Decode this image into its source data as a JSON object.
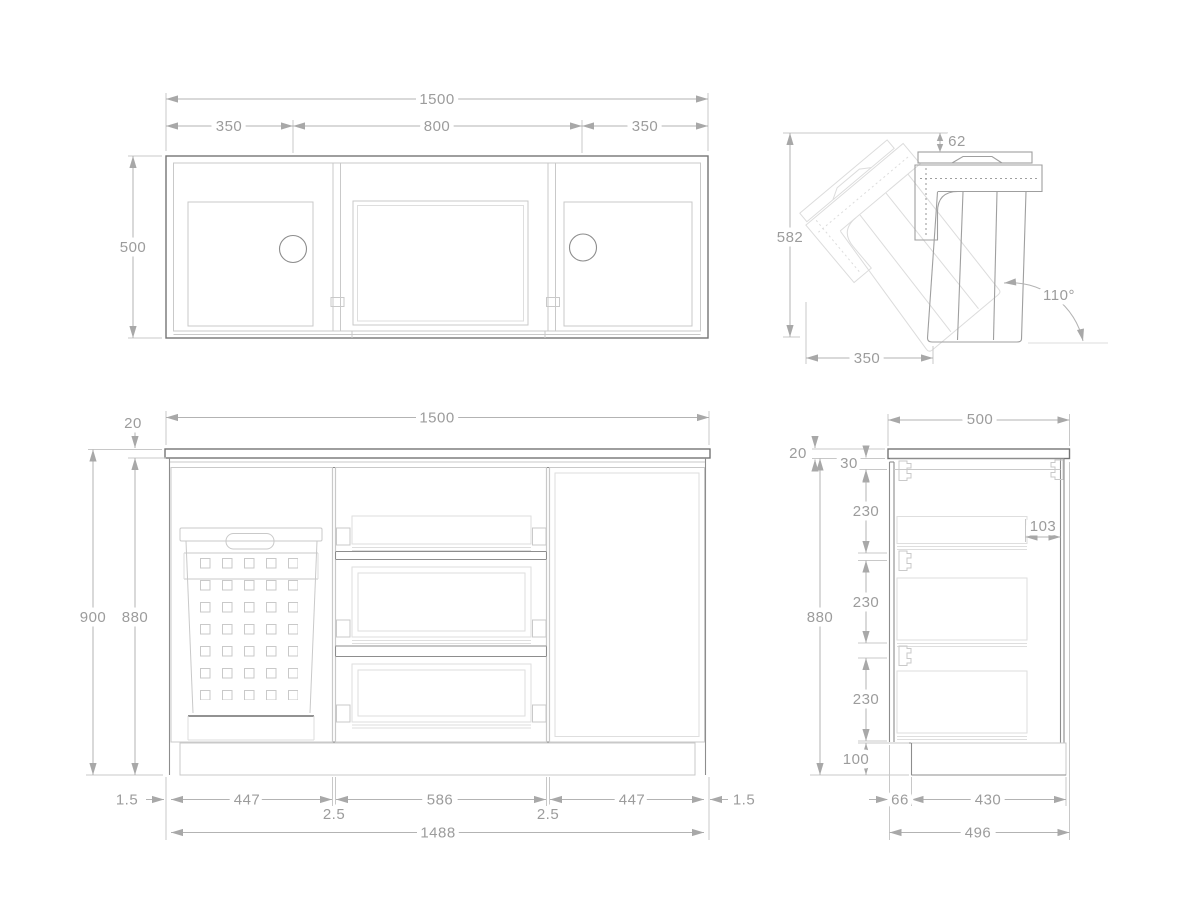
{
  "drawing": {
    "views": {
      "plan": {
        "dims": {
          "total_width": "1500",
          "bay_left": "350",
          "bay_center": "800",
          "bay_right": "350",
          "depth": "500"
        }
      },
      "tilt": {
        "dims": {
          "lid_gap": "62",
          "open_height": "582",
          "depth": "350",
          "open_angle": "110°"
        }
      },
      "front": {
        "dims": {
          "top_thickness": "20",
          "total_width": "1500",
          "total_height": "900",
          "body_height": "880",
          "gap_outer_left": "1.5",
          "front_left": "447",
          "gap_inner_left": "2.5",
          "front_center": "586",
          "gap_inner_right": "2.5",
          "front_right": "447",
          "gap_outer_right": "1.5",
          "fronts_width": "1488"
        }
      },
      "side": {
        "dims": {
          "depth": "500",
          "top_thickness": "20",
          "top_rail": "30",
          "drawer_top": "230",
          "drawer_inset": "103",
          "body_height": "880",
          "drawer_mid": "230",
          "drawer_bottom": "230",
          "plinth_height": "100",
          "toe_recess": "66",
          "plinth_depth": "430",
          "base_depth": "496"
        }
      }
    },
    "palette": {
      "object_line": "#757575",
      "medium_line": "#8d8d8d",
      "detail_line": "#c9c9c9",
      "faint_line": "#dedede",
      "ghost_line": "#dcdcdc",
      "dimension_line": "#b3b3b3",
      "extension_line": "#c8c8c8",
      "dimension_text": "#9c9c9c",
      "background": "#ffffff"
    }
  }
}
